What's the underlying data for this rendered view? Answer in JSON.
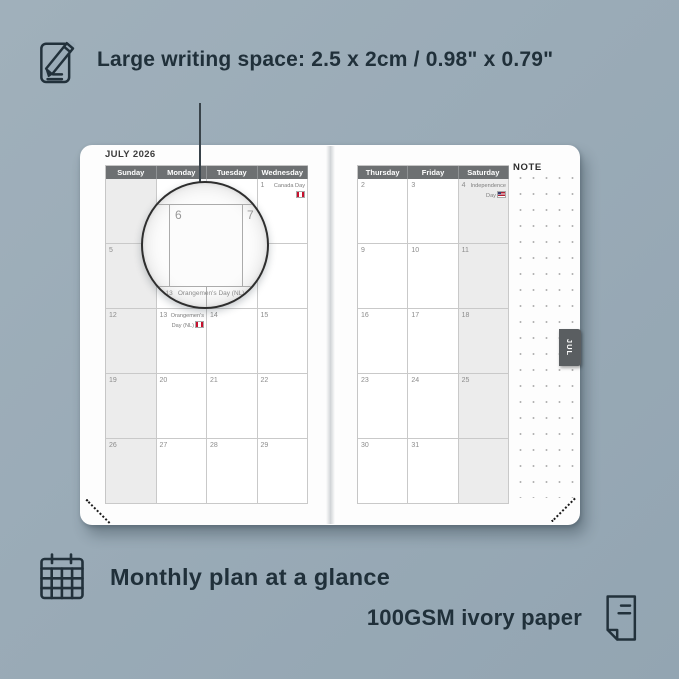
{
  "colors": {
    "background": "#9aabb7",
    "text_dark": "#20303a",
    "page": "#fdfdfd",
    "header_bg": "#6d7072",
    "header_text": "#ffffff",
    "weekend_shade": "#ececec",
    "cell_border": "#c9c9c9",
    "day_number": "#8c8c8c",
    "tab_bg": "#5a5e61",
    "flag_red": "#c8102e"
  },
  "top_feature": {
    "icon": "pencil-note-icon",
    "text": "Large writing space: 2.5 x 2cm / 0.98\" x 0.79\""
  },
  "planner": {
    "month_title": "JULY 2026",
    "tab_label": "JUL",
    "note_label": "NOTE",
    "left_page": {
      "headers": [
        "Sunday",
        "Monday",
        "Tuesday",
        "Wednesday"
      ],
      "rows": [
        [
          {
            "day": ""
          },
          {
            "day": ""
          },
          {
            "day": ""
          },
          {
            "day": "1",
            "holiday": "Canada Day"
          }
        ],
        [
          {
            "day": "5"
          },
          {
            "day": "6"
          },
          {
            "day": "7"
          },
          {
            "day": "8"
          }
        ],
        [
          {
            "day": "12"
          },
          {
            "day": "13",
            "holiday": "Orangemen's Day (NL)"
          },
          {
            "day": "14"
          },
          {
            "day": "15"
          }
        ],
        [
          {
            "day": "19"
          },
          {
            "day": "20"
          },
          {
            "day": "21"
          },
          {
            "day": "22"
          }
        ],
        [
          {
            "day": "26"
          },
          {
            "day": "27"
          },
          {
            "day": "28"
          },
          {
            "day": "29"
          }
        ]
      ]
    },
    "right_page": {
      "headers": [
        "Thursday",
        "Friday",
        "Saturday"
      ],
      "rows": [
        [
          {
            "day": "2"
          },
          {
            "day": "3"
          },
          {
            "day": "4",
            "holiday": "Independence Day"
          }
        ],
        [
          {
            "day": "9"
          },
          {
            "day": "10"
          },
          {
            "day": "11"
          }
        ],
        [
          {
            "day": "16"
          },
          {
            "day": "17"
          },
          {
            "day": "18"
          }
        ],
        [
          {
            "day": "23"
          },
          {
            "day": "24"
          },
          {
            "day": "25"
          }
        ],
        [
          {
            "day": "30"
          },
          {
            "day": "31"
          },
          {
            "day": ""
          }
        ]
      ]
    },
    "magnifier": {
      "day_left": "6",
      "day_right": "7",
      "bottom_text": "13  Orangemen's Day (NL)"
    }
  },
  "bottom_features": {
    "monthly": {
      "icon": "calendar-grid-icon",
      "text": "Monthly plan at a glance"
    },
    "paper": {
      "icon": "paper-sheet-icon",
      "text": "100GSM ivory paper"
    }
  }
}
